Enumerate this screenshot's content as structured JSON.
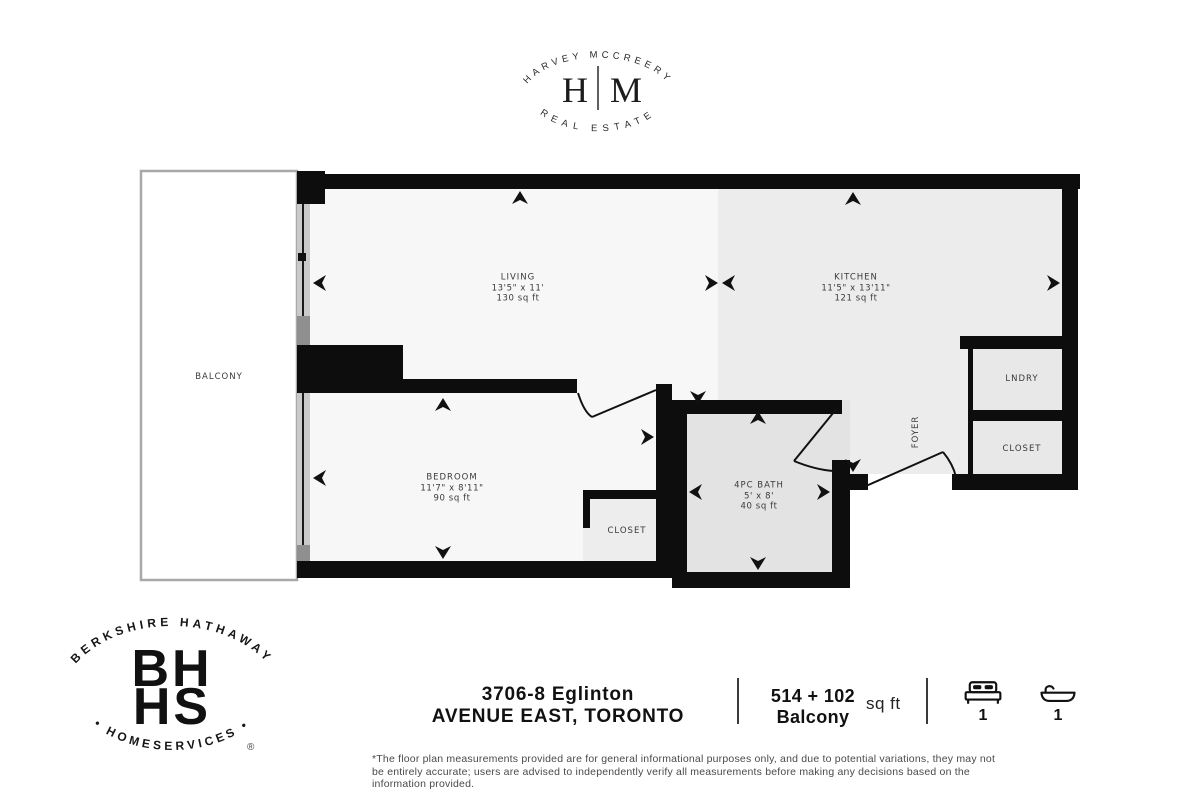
{
  "logo_hm": {
    "top_text": "HARVEY MCCREERY",
    "monogram_left": "H",
    "monogram_right": "M",
    "bottom_text": "REAL ESTATE"
  },
  "logo_bhhs": {
    "top_text": "BERKSHIRE HATHAWAY",
    "monogram_line1": "BH",
    "monogram_line2": "HS",
    "bottom_text": "• HOMESERVICES •",
    "registered_mark": "®"
  },
  "floor_plan": {
    "rooms": [
      {
        "id": "balcony",
        "name": "BALCONY",
        "dims": "",
        "area": ""
      },
      {
        "id": "living",
        "name": "LIVING",
        "dims": "13'5\" x 11'",
        "area": "130 sq ft"
      },
      {
        "id": "kitchen",
        "name": "KITCHEN",
        "dims": "11'5\" x 13'11\"",
        "area": "121 sq ft"
      },
      {
        "id": "bedroom",
        "name": "BEDROOM",
        "dims": "11'7\" x 8'11\"",
        "area": "90 sq ft"
      },
      {
        "id": "bath",
        "name": "4PC BATH",
        "dims": "5' x 8'",
        "area": "40 sq ft"
      },
      {
        "id": "closet_bedroom",
        "name": "CLOSET",
        "dims": "",
        "area": ""
      },
      {
        "id": "laundry",
        "name": "LNDRY",
        "dims": "",
        "area": ""
      },
      {
        "id": "closet_entry",
        "name": "CLOSET",
        "dims": "",
        "area": ""
      },
      {
        "id": "foyer",
        "name": "FOYER",
        "dims": "",
        "area": ""
      }
    ],
    "wall_color": "#0d0d0d"
  },
  "footer": {
    "address_line1": "3706-8 Eglinton",
    "address_line2": "AVENUE EAST, TORONTO",
    "area_line1": "514 + 102",
    "area_line2": "Balcony",
    "area_unit": "sq ft",
    "beds_count": "1",
    "baths_count": "1",
    "disclaimer_line1": "*The floor plan measurements provided are for general informational purposes only, and due to potential variations, they may not",
    "disclaimer_line2": "be entirely accurate; users are advised to independently verify all measurements before making any decisions based on the",
    "disclaimer_line3": "information provided."
  }
}
